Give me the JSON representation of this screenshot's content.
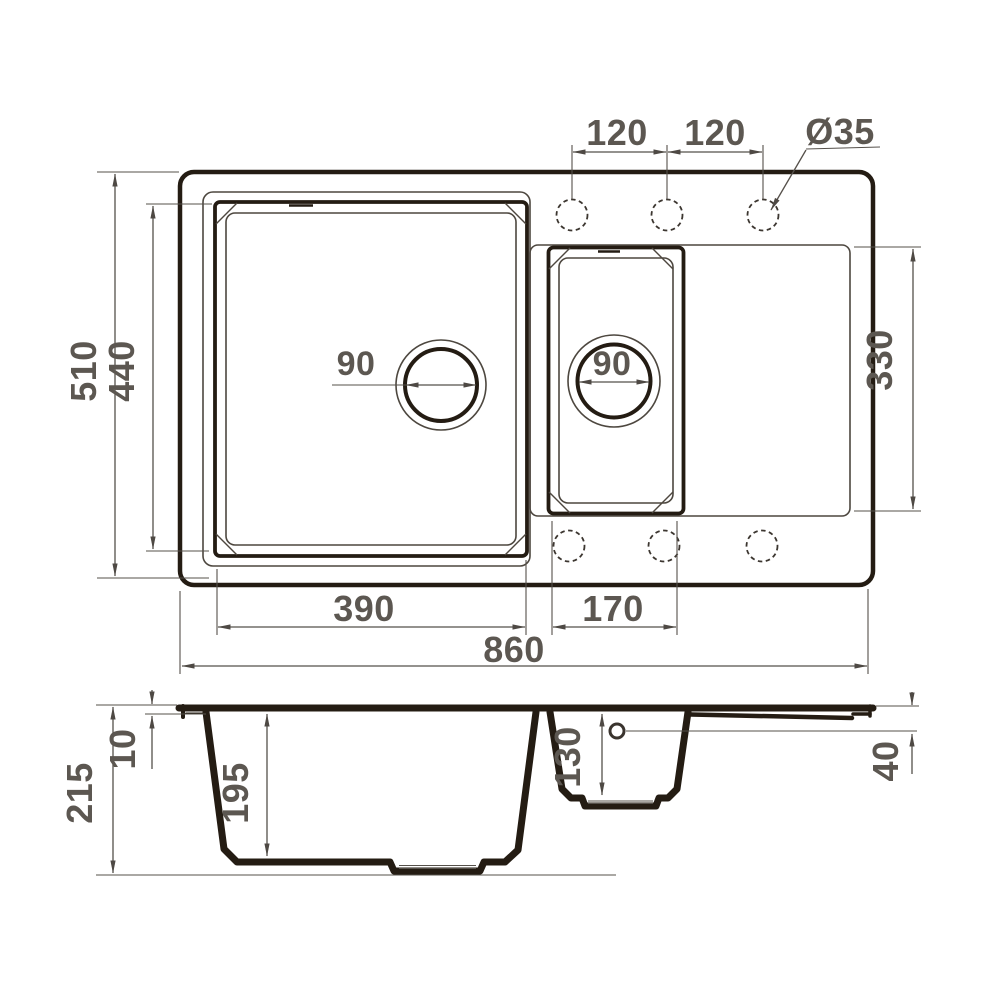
{
  "drawing": {
    "description": "Dimensioned technical drawing of a kitchen sink with main bowl, half bowl and drainboard: top view and cross-section",
    "units": "mm",
    "background_color": "#ffffff",
    "line_color": "#241c13",
    "dimension_line_color": "#55504a",
    "text_color": "#5c5751"
  },
  "top_view": {
    "faucet_hole_spacing_left": "120",
    "faucet_hole_spacing_right": "120",
    "faucet_hole_diameter": "Ø35",
    "overall_width": "860",
    "overall_depth": "510",
    "main_bowl_inner_depth": "440",
    "main_bowl_inner_width": "390",
    "main_bowl_drain_diameter": "90",
    "half_bowl_inner_width": "170",
    "half_bowl_drain_diameter": "90",
    "drainboard_section_depth": "330"
  },
  "section_view": {
    "overall_height": "215",
    "rim_height": "10",
    "main_bowl_depth": "195",
    "half_bowl_depth": "130",
    "edge_overflow_offset": "40"
  }
}
